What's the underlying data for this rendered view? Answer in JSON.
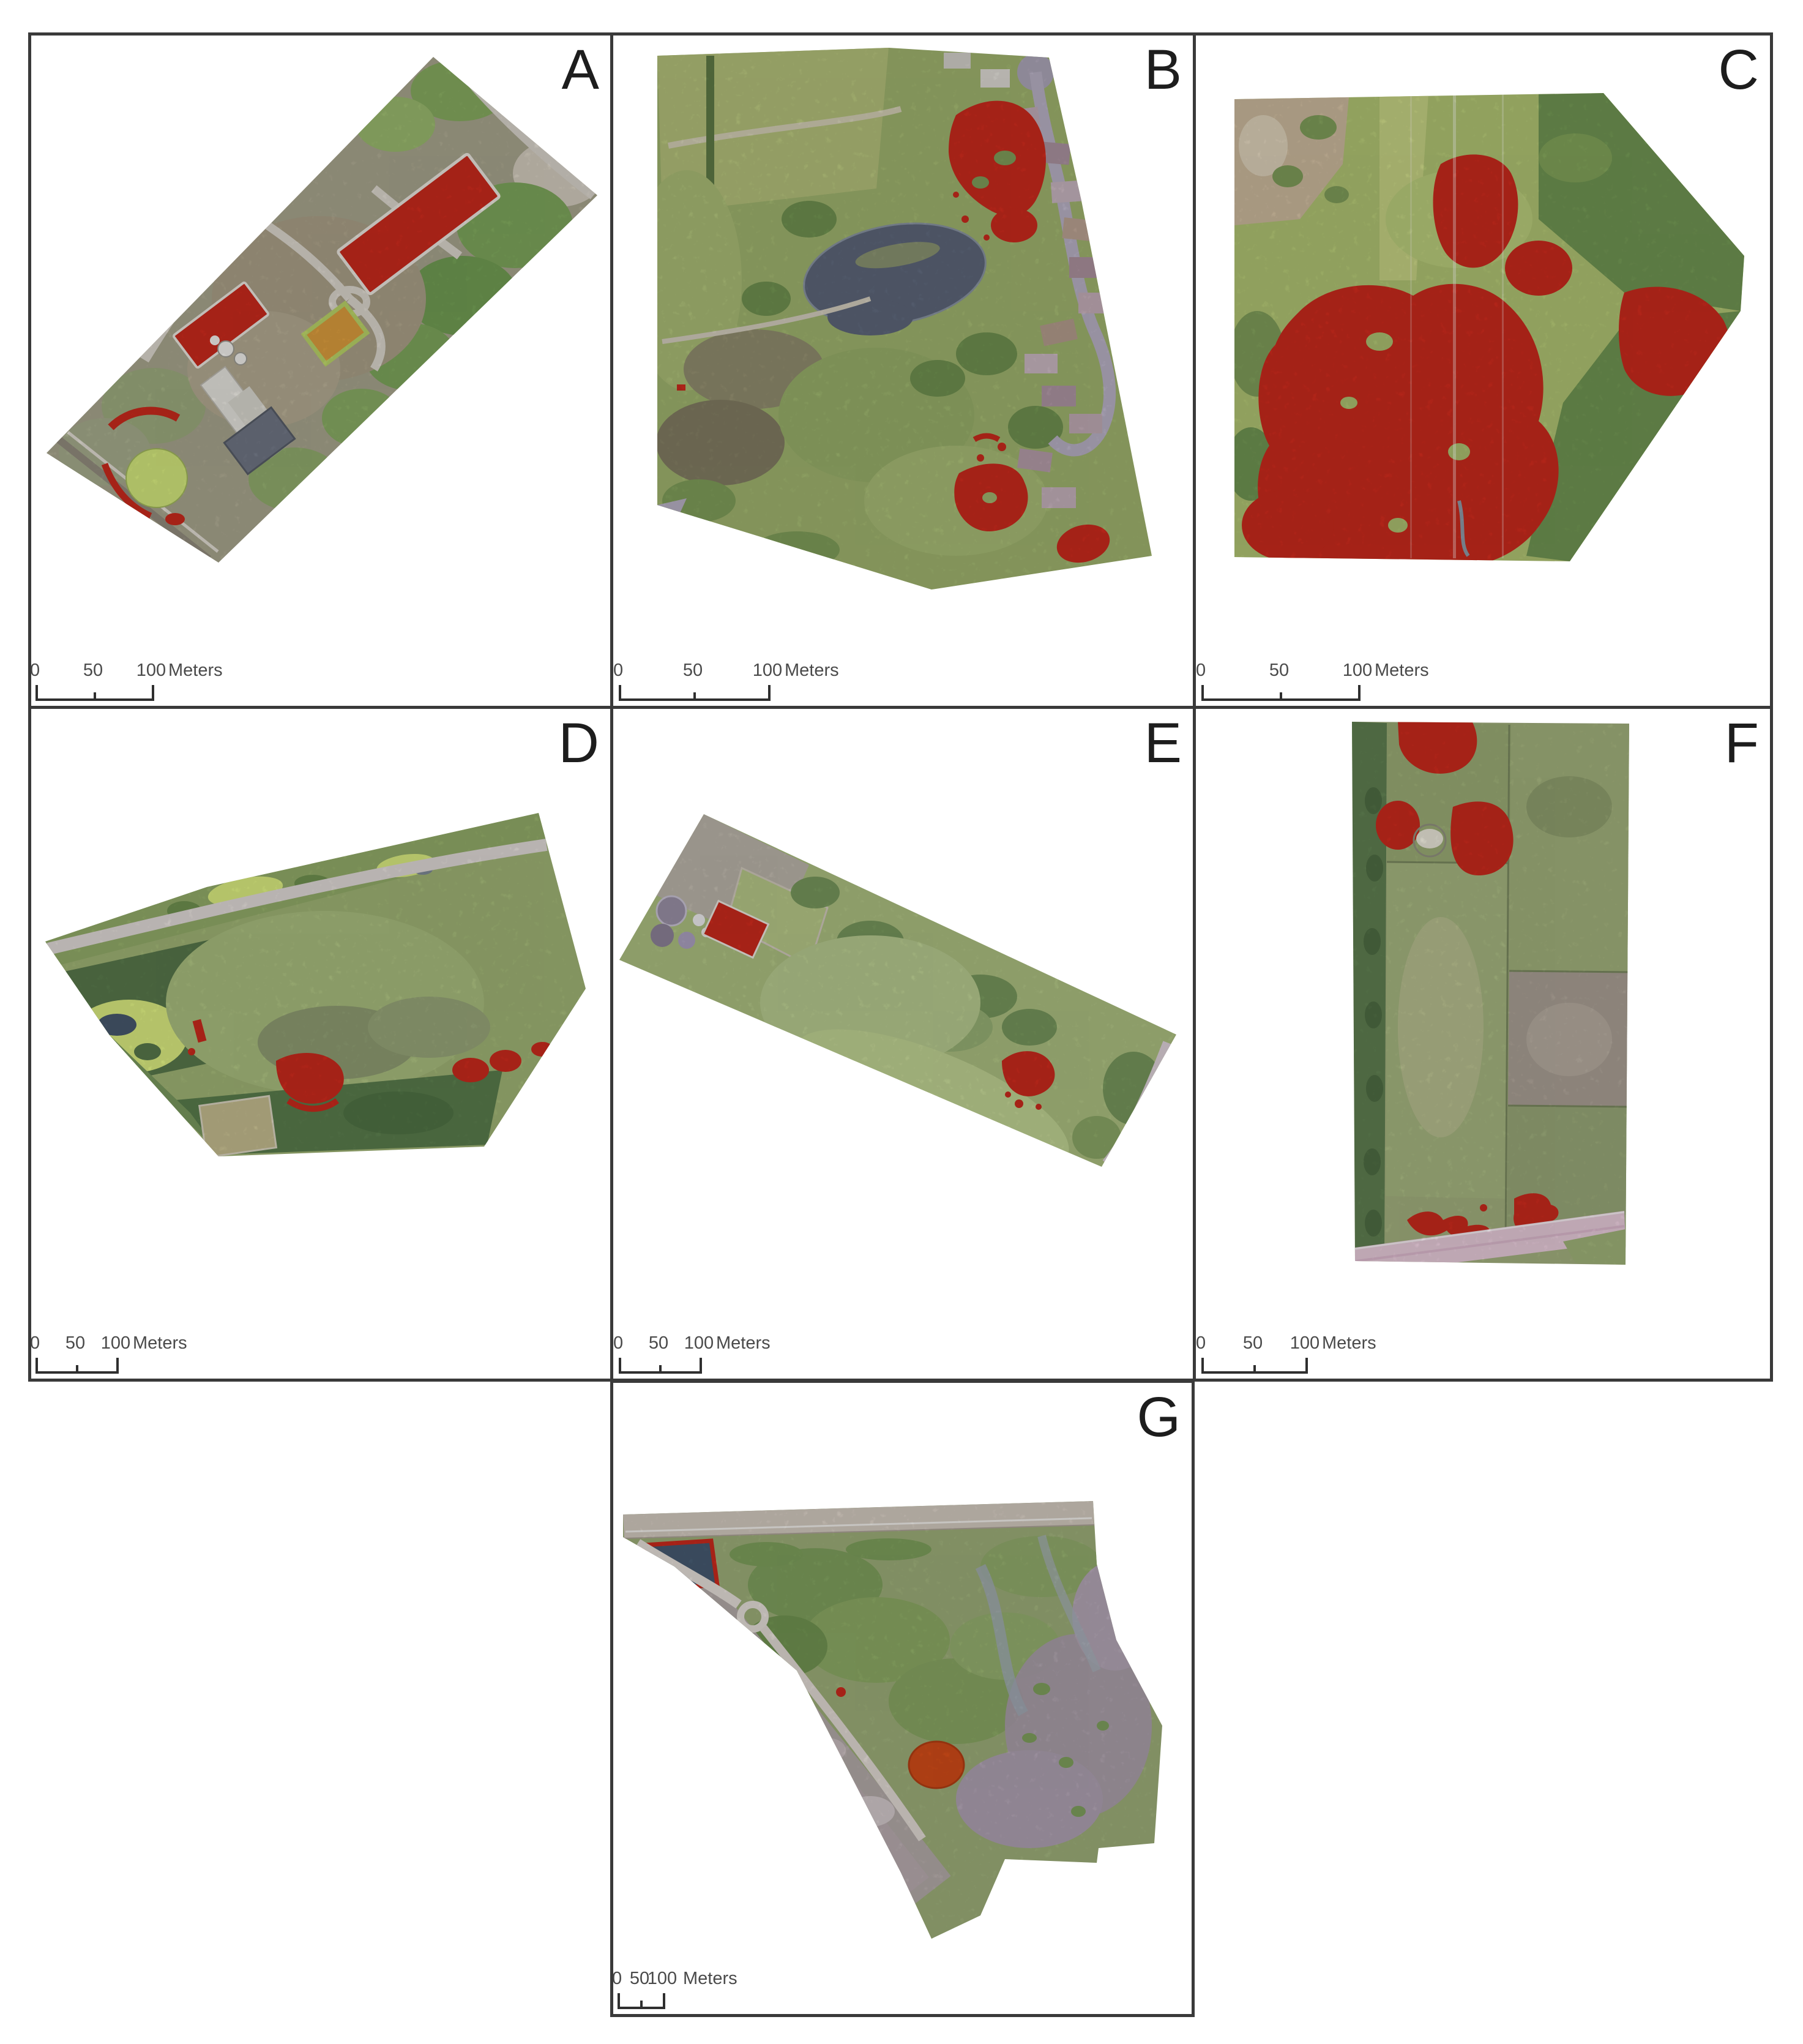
{
  "panels": [
    {
      "id": "A",
      "label": "A"
    },
    {
      "id": "B",
      "label": "B"
    },
    {
      "id": "C",
      "label": "C"
    },
    {
      "id": "D",
      "label": "D"
    },
    {
      "id": "E",
      "label": "E"
    },
    {
      "id": "F",
      "label": "F"
    },
    {
      "id": "G",
      "label": "G"
    }
  ],
  "scalebar": {
    "tick_0": "0",
    "tick_50": "50",
    "tick_100": "100",
    "unit_label": "Meters"
  },
  "colors": {
    "highlight_red": "#c5291c",
    "map_border": "#3a3a3a",
    "scalebar_text": "#4a4a4a",
    "scalebar_line": "#2f2f2f",
    "page_background": "#ffffff"
  }
}
